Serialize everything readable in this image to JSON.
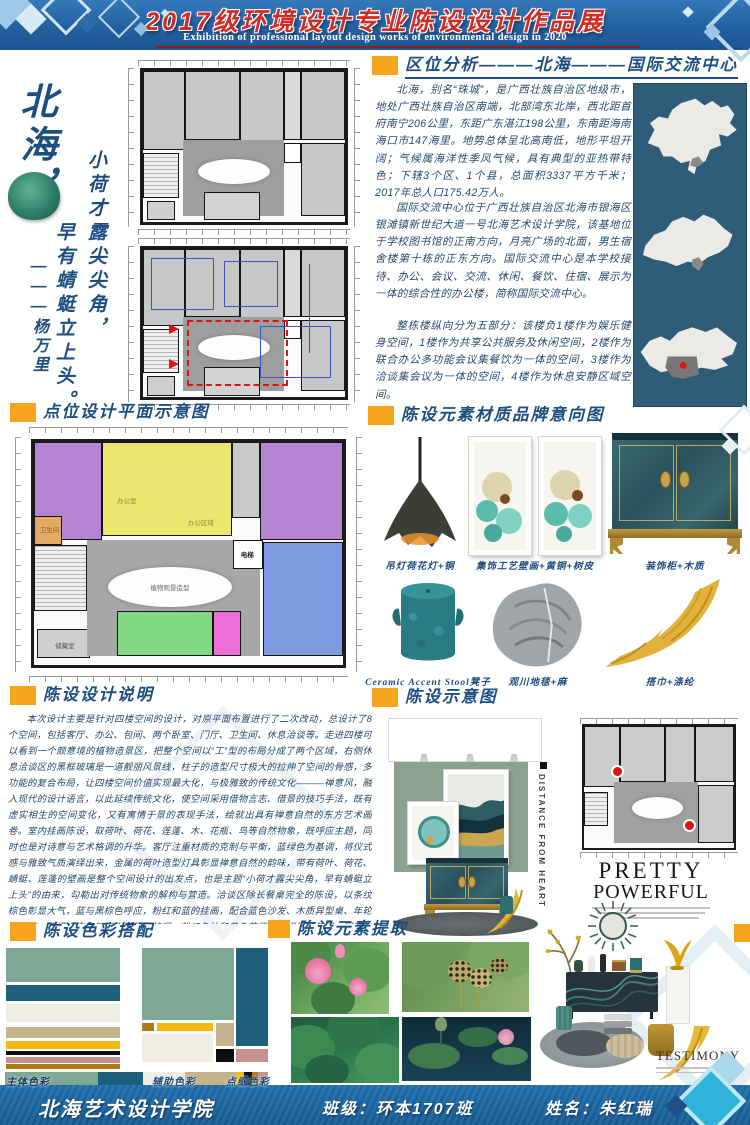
{
  "header": {
    "title": "2017级环境设计专业陈设设计作品展",
    "subtitle": "Exhibition of professional layout design works of environmental design in 2020"
  },
  "left_panel": {
    "city": "北海，",
    "poem_line1": "小荷才露尖尖角，",
    "poem_line2": "早有蜻蜓立上头。",
    "poem_author": "———杨万里"
  },
  "location": {
    "title": "区位分析———北海———国际交流中心",
    "para1": "北海，别名“珠城”，是广西壮族自治区地级市，地处广西壮族自治区南端，北部湾东北岸，西北距首府南宁206公里，东距广东湛江198公里，东南距海南海口市147海里。地势总体呈北高南低，地形平坦开阔；气候属海洋性季风气候，具有典型的亚热带特色；下辖3个区、1个县，总面积3337平方千米；2017年总人口175.42万人。",
    "para2": "国际交流中心位于广西壮族自治区北海市银海区银滩镇新世纪大道一号北海艺术设计学院，该基地位于学校图书馆的正南方向，月亮广场的北面，男生宿舍楼第十栋的正东方向。国际交流中心是本学校接待、办公、会议、交流、休闲、餐饮、住宿、展示为一体的综合性的办公楼，简称国际交流中心。",
    "para3": "整栋楼纵向分为五部分：该楼负1楼作为娱乐健身空间，1楼作为共享公共服务及休闲空间，2楼作为联合办公多功能会议集餐饮为一体的空间，3楼作为洽谈集会议为一体的空间，4楼作为休息安静区域空间。"
  },
  "point_plan": {
    "title": "点位设计平面示意图",
    "labels": {
      "office": "办公室",
      "office_area": "办公区域",
      "toilet": "卫生间",
      "elevator": "电梯",
      "storage": "储藏室",
      "center_feature": "植物观景造型"
    }
  },
  "materials": {
    "title": "陈设元素材质品牌意向图",
    "items": [
      {
        "caption": "吊灯荷花灯+铜"
      },
      {
        "caption": "集饰工艺壁画+黄铜+树皮"
      },
      {
        "caption": "装饰柜+木质"
      },
      {
        "caption": "Ceramic Accent Stool凳子"
      },
      {
        "caption": "观川地毯+麻"
      },
      {
        "caption": "搭巾+涤纶"
      }
    ]
  },
  "description": {
    "title": "陈设设计说明",
    "text": "本次设计主要是针对四楼空间的设计，对原平面布置进行了二次改动，总设计了8个空间，包括客厅、办公、包间、两个卧室、门厅、卫生间、休息洽谈等。走进四楼可以看到一个颇意境的植物造景区，把整个空间以“工”型的布局分成了两个区域，右侧休息洽谈区的黑框玻璃是一道靓丽风景线，柱子的造型尺寸极大的拉伸了空间的骨感，多功能的复合布局，让四楼空间价值实现最大化，与极雅致的传统文化———禅意风，融入现代的设计语言，以此延续传统文化，使空间采用借物言志、借景的技巧手法，既有虚实相生的空间变化，又有寓情于景的表现手法，绘就出具有禅意自然的东方艺术画卷。室内挂画陈设，取荷叶、荷花、莲蓬、木、花瓶、鸟等自然物象，既呼应主题，同时也是对诗意与艺术格调的升华。客厅注重材质的克制与平衡，蓝绿色为基调，将仪式感与雅致气质演绎出来，金属的荷叶造型灯具彰显禅意自然的韵味，带有荷叶、荷花、蜻蜓、莲蓬的壁画是整个空间设计的出发点，也是主题“小荷才露尖尖角，早有蜻蜓立上头”的由来，勾勒出对传统物象的解构与营造。洽谈区除长餐桌完全的陈设，以条纹棕色彰显大气，蓝与黑棕色呼应，粉红和蓝的挂画，配合蓝色沙发、木质异型桌、年轮纹地毯，演绎出青春又不失沉稳的格调，粉红色枕和黄色花瓶的点缀缓和氛围，展现出轻快简练的洽谈场景。整个空间以蓝绿色为主色调，黄色、米白、粉红为辅助色的陈设，适宜的比例，实现多样元素的碰撞演绎，形意并济、层次丰富，既有传统又有现代元素，结合多样材质风格，呈现出多样的情趣。"
  },
  "display": {
    "title": "陈设示意图",
    "vertical_caption": "DISTANCE FROM HEART",
    "pretty_line1": "PRETTY",
    "pretty_line2": "POWERFUL",
    "testimony": "TESTIMONY"
  },
  "colors": {
    "title": "陈设色彩搭配",
    "labels": {
      "main": "主体色彩",
      "aux": "辅助色彩",
      "accent": "点缀色彩"
    },
    "palette": {
      "sage": "#7EA795",
      "teal": "#1E5F7B",
      "ivory": "#EFEDE4",
      "tan": "#C4B28A",
      "yellow": "#F6B914",
      "black": "#0D0D0D",
      "pink": "#C7908F",
      "gold": "#AF7A12"
    }
  },
  "elements": {
    "title": "陈设元素提取"
  },
  "footer": {
    "school": "北海艺术设计学院",
    "class_label": "班级：环本1707班",
    "name_label": "姓名：朱红瑞"
  }
}
